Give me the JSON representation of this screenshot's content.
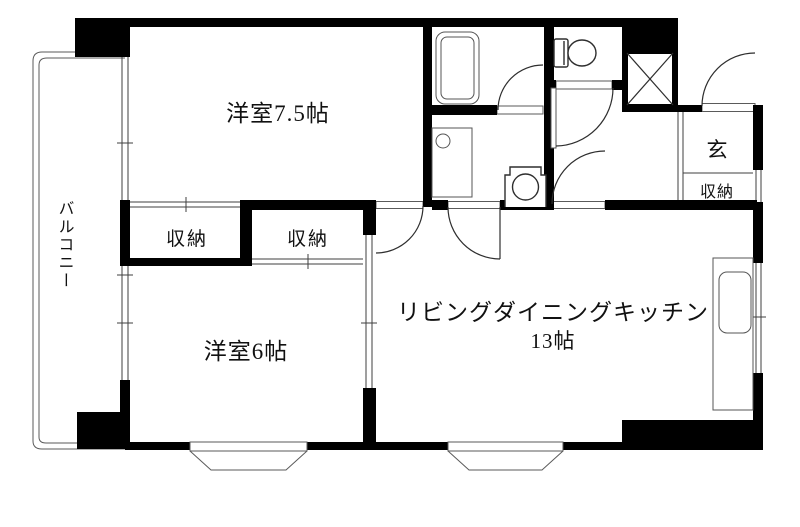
{
  "plan": {
    "kind": "japanese-apartment-floor-plan",
    "labels": {
      "room_7_5": "洋室7.5帖",
      "room_6": "洋室6帖",
      "ldk_name": "リビングダイニングキッチン",
      "ldk_size": "13帖",
      "closet_left": "収納",
      "closet_right": "収納",
      "entrance": "玄",
      "entrance_closet": "収納",
      "balcony": "バルコニー"
    },
    "fixtures": {
      "bathtub": "bathtub-icon",
      "washbasin": "washbasin-icon",
      "washing_machine": "washing-machine-icon",
      "toilet": "toilet-icon",
      "kitchen_counter": "kitchen-counter-icon",
      "kitchen_sink": "kitchen-sink-icon",
      "elevator": "elevator-shaft-icon",
      "bay_windows": 2
    },
    "colors": {
      "wall": "#000000",
      "line": "#3f3f3f",
      "background": "#ffffff"
    }
  }
}
